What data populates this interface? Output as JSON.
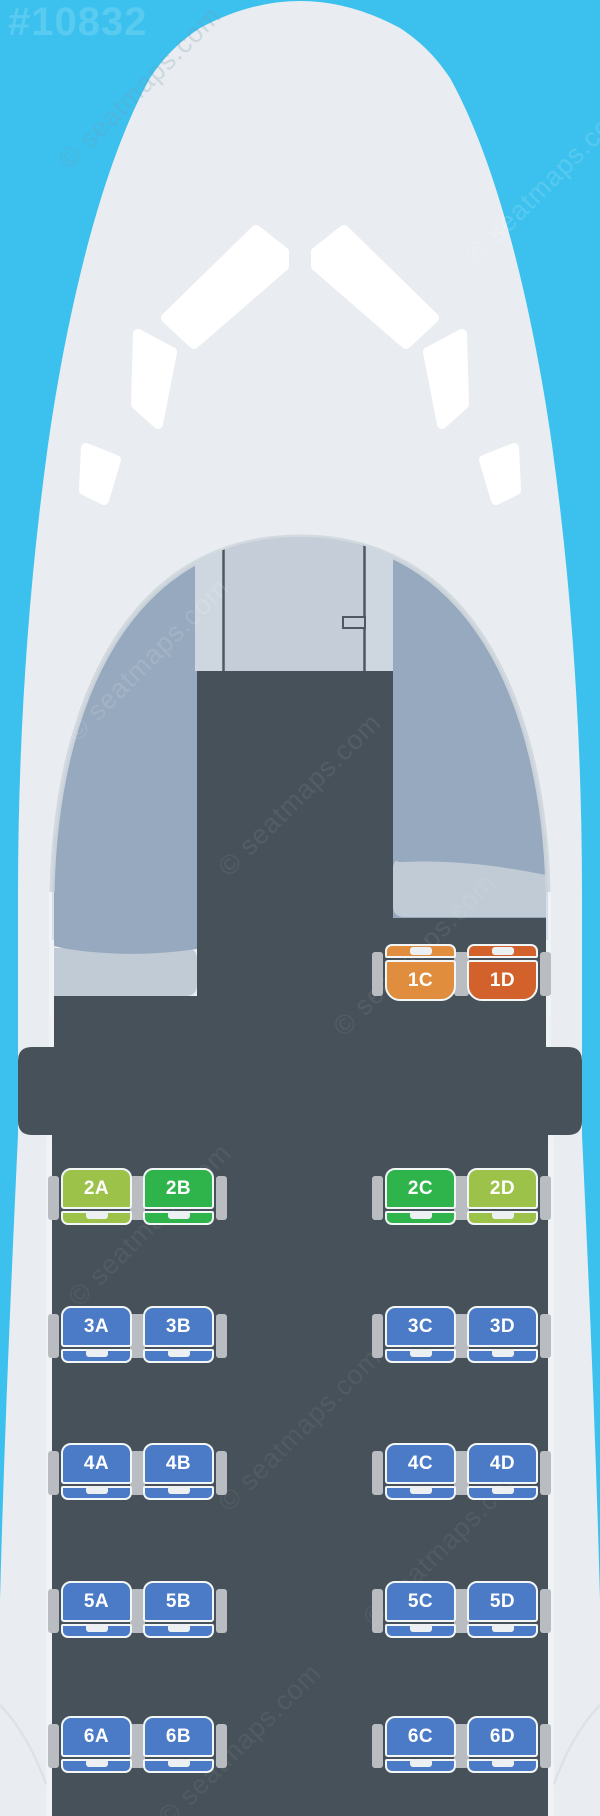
{
  "ref_number": "#10832",
  "watermark": {
    "text": "© seatmaps.com"
  },
  "palette": {
    "sky": "#3cc1ee",
    "fuselage": "#e9edf1",
    "windshield": "#ffffff",
    "cabin_wall": "#97a9be",
    "cabin_wall_rim": "#cfd6dd",
    "cockpit_panel": "#c4cdd8",
    "cockpit_panel_edge": "#ced6df",
    "panel_line": "#4d5863",
    "cabin_floor": "#475159",
    "sidewall_ledge": "#c0cbd6",
    "armrest": "#b9bdc2",
    "seat_outline": "#f3f6f7",
    "seat_notch": "#edf0f2",
    "seat_blue": "#4b7ac6",
    "seat_green": "#2fb44b",
    "seat_lime": "#9cc24a",
    "seat_orange_light": "#e08e3e",
    "seat_orange_dark": "#d2612c"
  },
  "cabin": {
    "layout": "A B | C D",
    "rows": [
      {
        "number": "1",
        "seats": [
          {
            "label": "1C",
            "tier": "orange-light"
          },
          {
            "label": "1D",
            "tier": "orange-dark"
          }
        ]
      },
      {
        "number": "2",
        "seats": [
          {
            "label": "2A",
            "tier": "lime"
          },
          {
            "label": "2B",
            "tier": "green"
          },
          {
            "label": "2C",
            "tier": "green"
          },
          {
            "label": "2D",
            "tier": "lime"
          }
        ]
      },
      {
        "number": "3",
        "seats": [
          {
            "label": "3A",
            "tier": "blue"
          },
          {
            "label": "3B",
            "tier": "blue"
          },
          {
            "label": "3C",
            "tier": "blue"
          },
          {
            "label": "3D",
            "tier": "blue"
          }
        ]
      },
      {
        "number": "4",
        "seats": [
          {
            "label": "4A",
            "tier": "blue"
          },
          {
            "label": "4B",
            "tier": "blue"
          },
          {
            "label": "4C",
            "tier": "blue"
          },
          {
            "label": "4D",
            "tier": "blue"
          }
        ]
      },
      {
        "number": "5",
        "seats": [
          {
            "label": "5A",
            "tier": "blue"
          },
          {
            "label": "5B",
            "tier": "blue"
          },
          {
            "label": "5C",
            "tier": "blue"
          },
          {
            "label": "5D",
            "tier": "blue"
          }
        ]
      },
      {
        "number": "6",
        "seats": [
          {
            "label": "6A",
            "tier": "blue"
          },
          {
            "label": "6B",
            "tier": "blue"
          },
          {
            "label": "6C",
            "tier": "blue"
          },
          {
            "label": "6D",
            "tier": "blue"
          }
        ]
      }
    ]
  }
}
